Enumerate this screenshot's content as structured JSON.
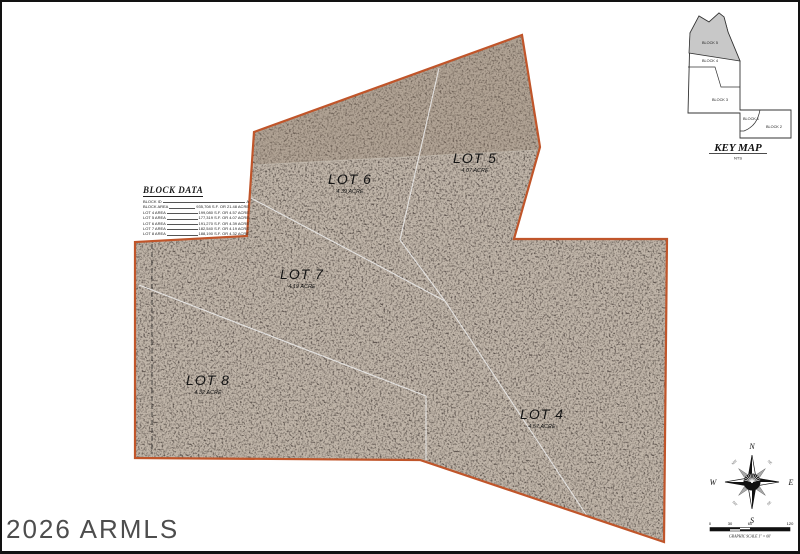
{
  "document": {
    "type_note": "aerial plat map of subdivision lots",
    "watermark": "2026 ARMLS"
  },
  "lots": {
    "lot4": {
      "label": "LOT 4",
      "area": "4.57 ACRE"
    },
    "lot5": {
      "label": "LOT 5",
      "area": "4.07 ACRE"
    },
    "lot6": {
      "label": "LOT 6",
      "area": "4.39 ACRE"
    },
    "lot7": {
      "label": "LOT 7",
      "area": "4.19 ACRE"
    },
    "lot8": {
      "label": "LOT 8",
      "area": "4.32 ACRE"
    }
  },
  "block_data": {
    "title": "BLOCK DATA",
    "rows": [
      {
        "label": "BLOCK ID",
        "value": "A"
      },
      {
        "label": "BLOCK AREA",
        "value": "935,708 S.F. OR 21.48 ACRE"
      },
      {
        "label": "LOT 4 AREA",
        "value": "199,080 S.F. OR 4.57 ACRE"
      },
      {
        "label": "LOT 5 AREA",
        "value": "177,319 S.F. OR 4.07 ACRE"
      },
      {
        "label": "LOT 6 AREA",
        "value": "191,270 S.F. OR 4.39 ACRE"
      },
      {
        "label": "LOT 7 AREA",
        "value": "182,540 S.F. OR 4.19 ACRE"
      },
      {
        "label": "LOT 8 AREA",
        "value": "188,190 S.F. OR 4.32 ACRE"
      }
    ]
  },
  "key_map": {
    "title": "KEY MAP",
    "scale_note": "NTS",
    "blocks": {
      "block1": "BLOCK 1",
      "block2": "BLOCK 2",
      "block3": "BLOCK 3",
      "block4": "BLOCK 4",
      "block5": "BLOCK 5"
    }
  },
  "compass": {
    "north": "N",
    "south": "S",
    "east": "E",
    "west": "W",
    "northeast": "NE",
    "northwest": "NW",
    "southeast": "SE",
    "southwest": "SW"
  },
  "scale_bar": {
    "ticks": [
      "0",
      "30",
      "60",
      "120"
    ],
    "caption": "GRAPHIC SCALE 1\" = 60'"
  },
  "colors": {
    "parcel_boundary": "#c0552a",
    "lot_line": "#efefef",
    "aerial_base": "#574c44",
    "keymap_shade": "#c8c8c8"
  }
}
